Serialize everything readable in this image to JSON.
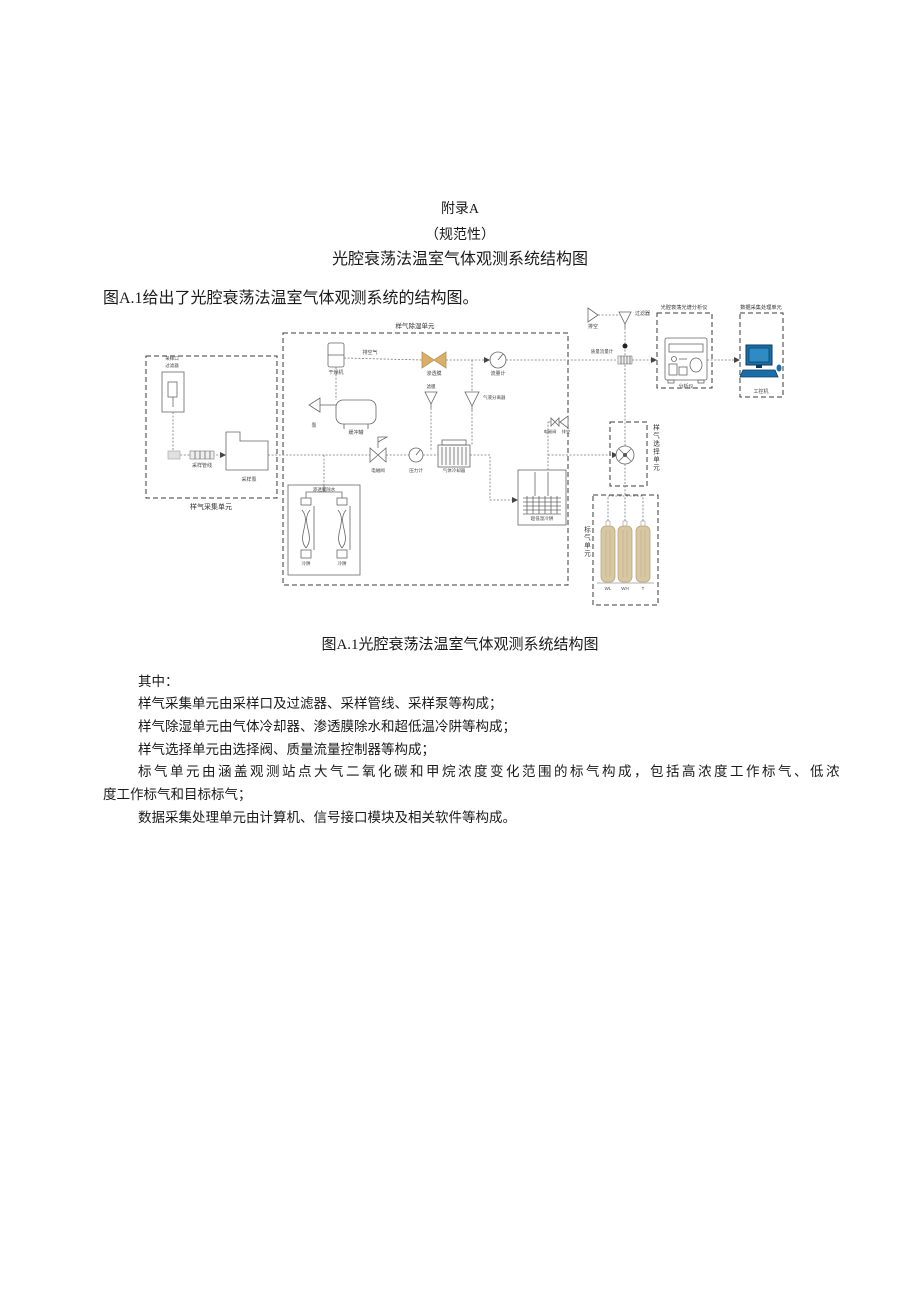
{
  "document": {
    "appendix": "附录A",
    "normative": "（规范性）",
    "title": "光腔衰荡法温室气体观测系统结构图",
    "intro": "图A.1给出了光腔衰荡法温室气体观测系统的结构图。",
    "caption": "图A.1光腔衰荡法温室气体观测系统结构图",
    "lead": "其中：",
    "body_lines": [
      "样气采集单元由采样口及过滤器、采样管线、采样泵等构成；",
      "样气除湿单元由气体冷却器、渗透膜除水和超低温冷阱等构成；",
      "样气选择单元由选择阀、质量流量控制器等构成；",
      "标气单元由涵盖观测站点大气二氧化碳和甲烷浓度变化范围的标气构成，包括高浓度工作标气、低浓",
      "度工作标气和目标标气；",
      "数据采集处理单元由计算机、信号接口模块及相关软件等构成。"
    ]
  },
  "diagram": {
    "units": {
      "sampling": "样气采集单元",
      "dehumid": "样气除湿单元",
      "selection": "样气选择单元",
      "standard": "标气单元",
      "analyzer": "光腔衰荡光谱分析仪",
      "data": "数据采集处理单元"
    },
    "labels": {
      "inlet": "采样口",
      "inlet_filter": "过滤器",
      "sample_line": "采样管线",
      "sample_pump": "采样泵",
      "dryer": "干燥机",
      "vent_air": "排空气",
      "membrane": "渗透膜",
      "flowmeter": "流量计",
      "mem_filter": "滤膜",
      "separator": "气液分离器",
      "pump": "泵",
      "buffer": "缓冲罐",
      "solenoid": "电磁阀",
      "pressure": "压力计",
      "cooler": "气体冷却器",
      "membrane_unit": "渗透膜除水",
      "trap_a": "冷阱",
      "trap_b": "冷阱",
      "cryotrap": "超低温冷阱",
      "vent_valve": "电磁阀",
      "vent_side": "排空",
      "vent_top": "排空",
      "top_filter": "过滤器",
      "mfm": "质量流量计",
      "analyzer_inst": "分析仪",
      "computer": "工控机",
      "cyl_low": "WL",
      "cyl_high": "WH",
      "cyl_target": "T"
    },
    "colors": {
      "membrane": "#d9af6a",
      "membrane_edge": "#b8924e",
      "cylinder": "#d7c7a2",
      "cylinder_edge": "#b9a77f",
      "computer_body": "#1b6fa8",
      "computer_screen": "#2e8bc4",
      "computer_dark": "#0d3a5c"
    }
  }
}
